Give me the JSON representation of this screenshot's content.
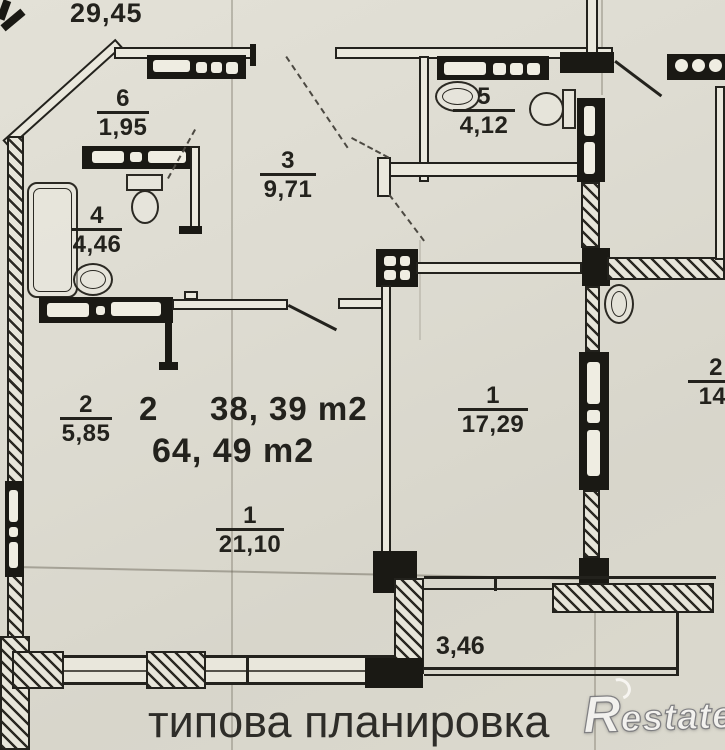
{
  "document": {
    "neighbor_top_area": "29,45",
    "caption": "типова планировка",
    "watermark_initial": "R",
    "watermark_rest": "estate"
  },
  "summary": {
    "rooms_count": "2",
    "living_area": "38, 39 m2",
    "total_area": "64, 49 m2"
  },
  "rooms": [
    {
      "id": "hall",
      "number": "6",
      "area": "1,95"
    },
    {
      "id": "bathroom",
      "number": "4",
      "area": "4,46"
    },
    {
      "id": "corridor",
      "number": "3",
      "area": "9,71"
    },
    {
      "id": "wc",
      "number": "5",
      "area": "4,12"
    },
    {
      "id": "kitchen",
      "number": "2",
      "area": "5,85"
    },
    {
      "id": "living-room",
      "number": "1",
      "area": "21,10"
    },
    {
      "id": "bedroom",
      "number": "1",
      "area": "17,29"
    },
    {
      "id": "neighbor",
      "number": "2",
      "area": "14,"
    },
    {
      "id": "balcony",
      "number": "",
      "area": "3,46"
    }
  ],
  "colors": {
    "paper": "#dedcd2",
    "ink": "#23221d"
  }
}
